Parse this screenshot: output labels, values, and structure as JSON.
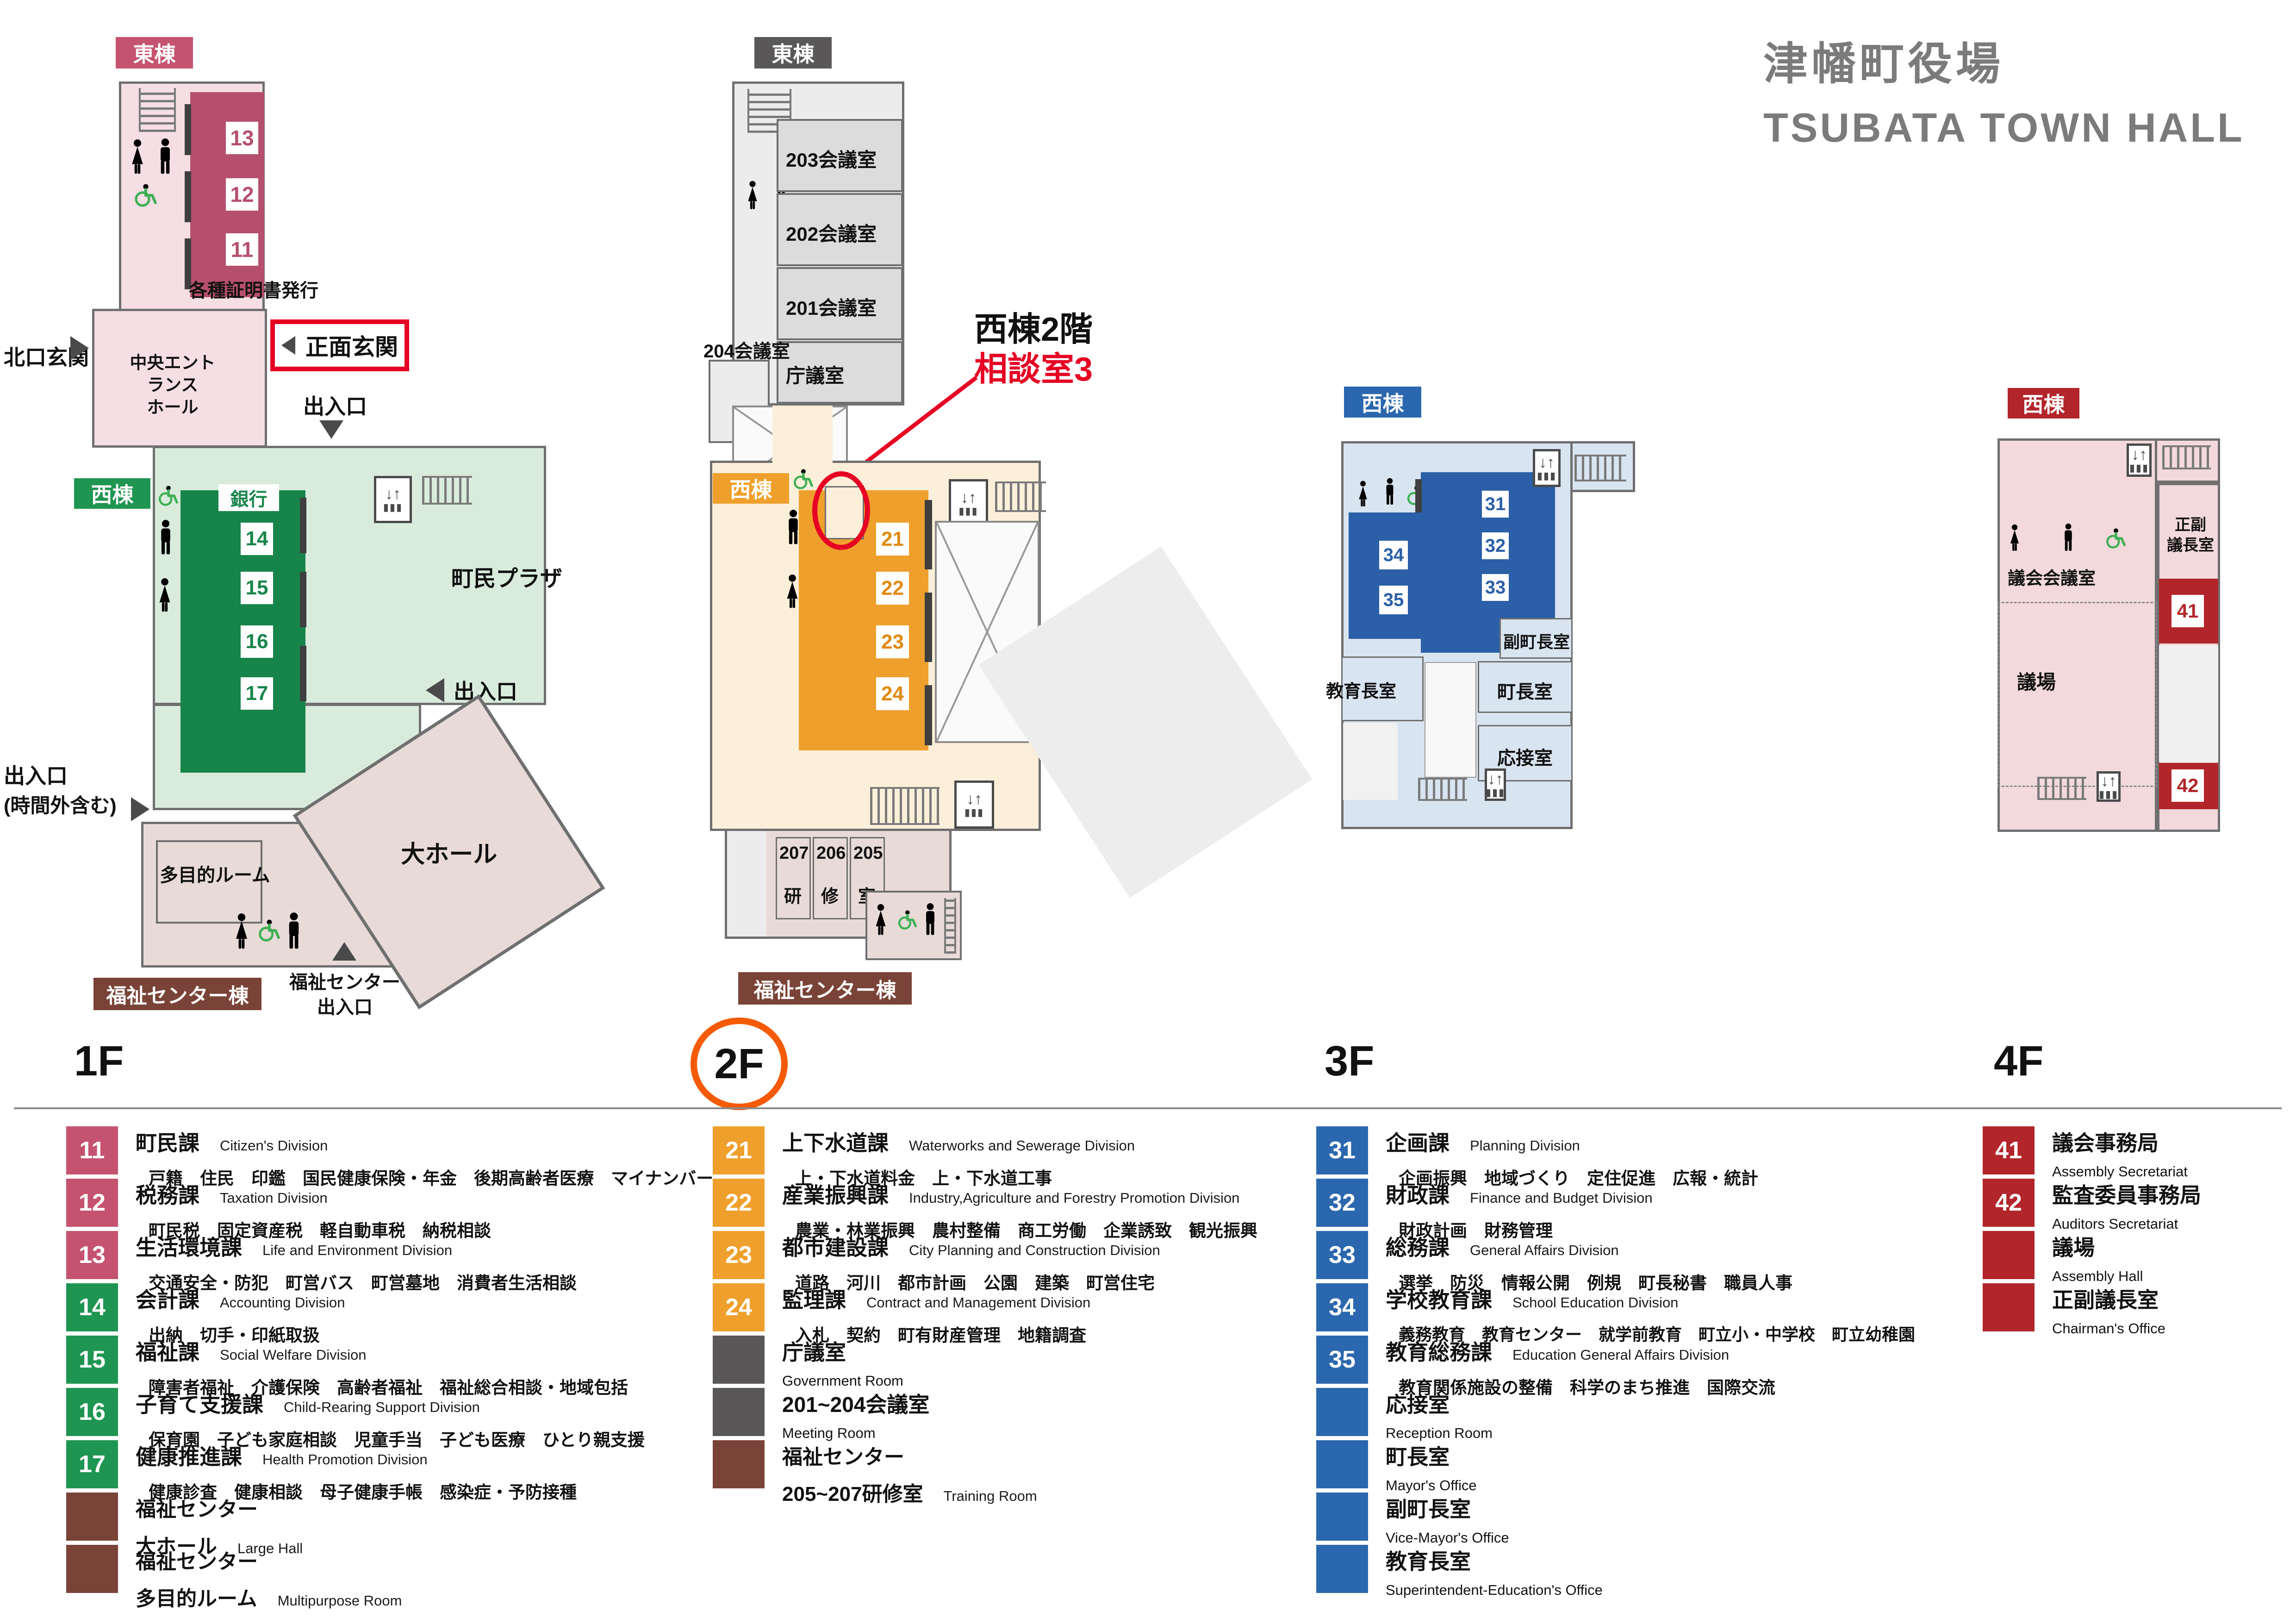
{
  "colors": {
    "crimson": "#c5536f",
    "crimson_room": "#b64f6d",
    "green": "#1f9552",
    "green_room": "#17854a",
    "orange": "#efa02c",
    "blue": "#2b67ae",
    "darkred": "#b2252a",
    "brown": "#7a4337",
    "gray": "#595757",
    "red_accent": "#e60023",
    "orange_circle": "#f55b05",
    "title_gray": "#7b7b7b"
  },
  "title": {
    "ja": "津幡町役場",
    "en": "TSUBATA TOWN HALL"
  },
  "floor_labels": {
    "f1": "1F",
    "f2": "2F",
    "f3": "3F",
    "f4": "4F"
  },
  "icons": {
    "elevator": "elevator",
    "stairs": "stairs",
    "man": "man-figure",
    "woman": "woman-figure",
    "wheelchair": "wheelchair-figure"
  },
  "f1": {
    "badge_east": "東棟",
    "badge_west": "西棟",
    "badge_welfare": "福祉センター棟",
    "chips_east": [
      "13",
      "12",
      "11"
    ],
    "chips_west": [
      "14",
      "15",
      "16",
      "17"
    ],
    "bank": "銀行",
    "certificates": "各種証明書発行",
    "north_entrance": "北口玄関",
    "main_entrance": "正面玄関",
    "hall_line1": "中央エントランス",
    "hall_line2": "ホール",
    "exit_top": "出入口",
    "exit_right": "出入口",
    "exit_afterhours_line1": "出入口",
    "exit_afterhours_line2": "(時間外含む)",
    "plaza": "町民プラザ",
    "multipurpose": "多目的ルーム",
    "large_hall": "大ホール",
    "welfare_exit_line1": "福祉センター",
    "welfare_exit_line2": "出入口"
  },
  "f2": {
    "badge_east": "東棟",
    "badge_west": "西棟",
    "badge_welfare": "福祉センター棟",
    "rooms_east": [
      "203会議室",
      "202会議室",
      "201会議室",
      "庁議室"
    ],
    "room_204": "204会議室",
    "chips_west": [
      "21",
      "22",
      "23",
      "24"
    ],
    "annotation_line1": "西棟2階",
    "annotation_line2": "相談室3",
    "training_numbers": [
      "207",
      "206",
      "205"
    ],
    "training_chars": [
      "研",
      "修",
      "室"
    ]
  },
  "f3": {
    "badge_west": "西棟",
    "chips_right": [
      "31",
      "32",
      "33"
    ],
    "chips_left": [
      "34",
      "35"
    ],
    "rooms": {
      "vice_mayor": "副町長室",
      "mayor": "町長室",
      "reception": "応接室",
      "superintendent": "教育長室"
    }
  },
  "f4": {
    "badge_west": "西棟",
    "chips": [
      "41",
      "42"
    ],
    "rooms": {
      "chairman_line1": "正副",
      "chairman_line2": "議長室",
      "assembly_meeting": "議会会議室",
      "assembly_hall": "議場"
    }
  },
  "legend": {
    "f1": [
      {
        "num": "11",
        "title": "町民課",
        "en": "Citizen's Division",
        "desc": "戸籍　住民　印鑑　国民健康保険・年金　後期高齢者医療　マイナンバー"
      },
      {
        "num": "12",
        "title": "税務課",
        "en": "Taxation Division",
        "desc": "町民税　固定資産税　軽自動車税　納税相談"
      },
      {
        "num": "13",
        "title": "生活環境課",
        "en": "Life and Environment Division",
        "desc": "交通安全・防犯　町営バス　町営墓地　消費者生活相談"
      },
      {
        "num": "14",
        "title": "会計課",
        "en": "Accounting Division",
        "desc": "出納　切手・印紙取扱"
      },
      {
        "num": "15",
        "title": "福祉課",
        "en": "Social Welfare Division",
        "desc": "障害者福祉　介護保険　高齢者福祉　福祉総合相談・地域包括"
      },
      {
        "num": "16",
        "title": "子育て支援課",
        "en": "Child-Rearing Support Division",
        "desc": "保育園　子ども家庭相談　児童手当　子ども医療　ひとり親支援"
      },
      {
        "num": "17",
        "title": "健康推進課",
        "en": "Health Promotion Division",
        "desc": "健康診査　健康相談　母子健康手帳　感染症・予防接種"
      },
      {
        "num": "",
        "title": "福祉センター",
        "line2": "大ホール",
        "en2": "Large Hall"
      },
      {
        "num": "",
        "title": "福祉センター",
        "line2": "多目的ルーム",
        "en2": "Multipurpose Room"
      }
    ],
    "f2": [
      {
        "num": "21",
        "title": "上下水道課",
        "en": "Waterworks and Sewerage Division",
        "desc": "上・下水道料金　上・下水道工事"
      },
      {
        "num": "22",
        "title": "産業振興課",
        "en": "Industry,Agriculture and Forestry Promotion Division",
        "desc": "農業・林業振興　農村整備　商工労働　企業誘致　観光振興"
      },
      {
        "num": "23",
        "title": "都市建設課",
        "en": "City Planning and Construction Division",
        "desc": "道路　河川　都市計画　公園　建築　町営住宅"
      },
      {
        "num": "24",
        "title": "監理課",
        "en": "Contract and Management Division",
        "desc": "入札　契約　町有財産管理　地籍調査"
      },
      {
        "num": "",
        "title": "庁議室",
        "en_line": "Government Room"
      },
      {
        "num": "",
        "title": "201~204会議室",
        "en_line": "Meeting Room"
      },
      {
        "num": "",
        "title": "福祉センター",
        "line2": "205~207研修室",
        "en2": "Training Room"
      }
    ],
    "f3": [
      {
        "num": "31",
        "title": "企画課",
        "en": "Planning Division",
        "desc": "企画振興　地域づくり　定住促進　広報・統計"
      },
      {
        "num": "32",
        "title": "財政課",
        "en": "Finance and Budget Division",
        "desc": "財政計画　財務管理"
      },
      {
        "num": "33",
        "title": "総務課",
        "en": "General Affairs Division",
        "desc": "選挙　防災　情報公開　例規　町長秘書　職員人事"
      },
      {
        "num": "34",
        "title": "学校教育課",
        "en": "School Education Division",
        "desc": "義務教育　教育センター　就学前教育　町立小・中学校　町立幼稚園"
      },
      {
        "num": "35",
        "title": "教育総務課",
        "en": "Education General Affairs Division",
        "desc": "教育関係施設の整備　科学のまち推進　国際交流"
      },
      {
        "num": "",
        "title": "応接室",
        "en_line": "Reception Room"
      },
      {
        "num": "",
        "title": "町長室",
        "en_line": "Mayor's Office"
      },
      {
        "num": "",
        "title": "副町長室",
        "en_line": "Vice-Mayor's Office"
      },
      {
        "num": "",
        "title": "教育長室",
        "en_line": "Superintendent-Education's Office"
      }
    ],
    "f4": [
      {
        "num": "41",
        "title": "議会事務局",
        "en_line": "Assembly Secretariat"
      },
      {
        "num": "42",
        "title": "監査委員事務局",
        "en_line": "Auditors Secretariat"
      },
      {
        "num": "",
        "title": "議場",
        "en_line": "Assembly Hall"
      },
      {
        "num": "",
        "title": "正副議長室",
        "en_line": "Chairman's Office"
      }
    ]
  }
}
